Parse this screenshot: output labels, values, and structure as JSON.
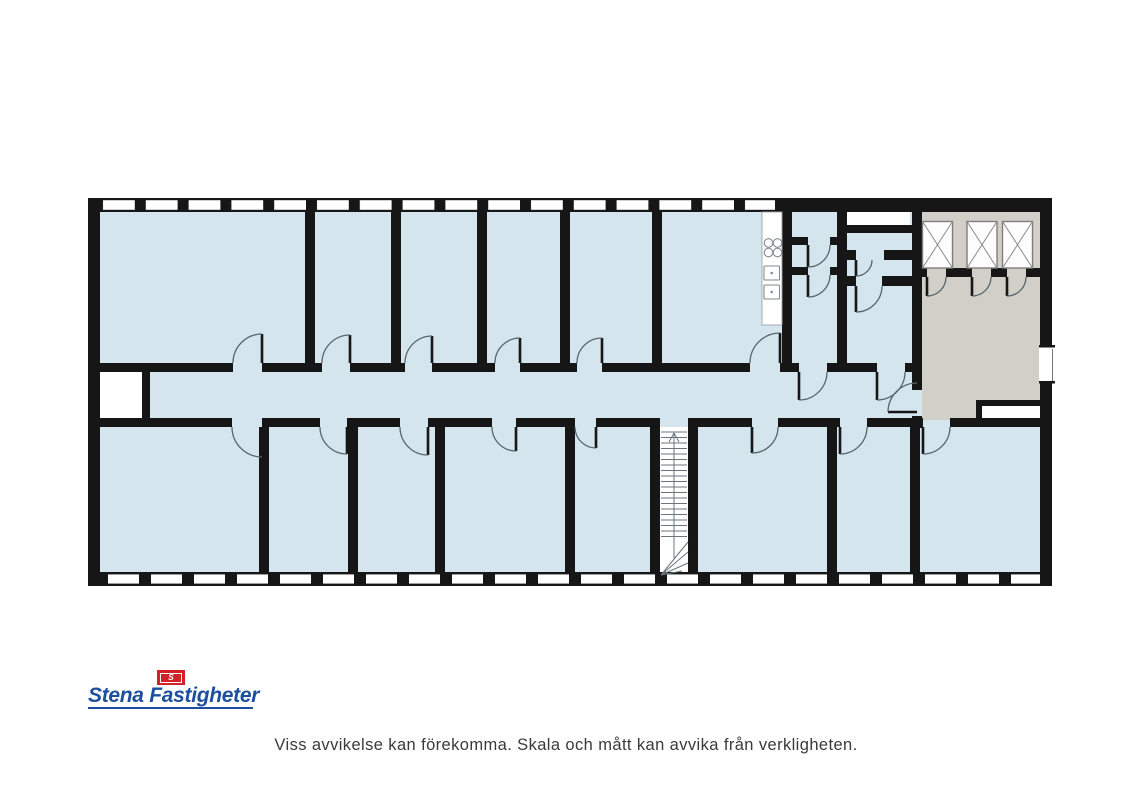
{
  "logo": {
    "brand": "Stena Fastigheter",
    "flag_letter": "S"
  },
  "disclaimer": "Viss avvikelse kan förekomma. Skala och mått kan avvika från verkligheten.",
  "plan": {
    "elevator_count": 3,
    "staircase_count": 1,
    "icons": {
      "elevator-symbol": "crossed-box",
      "stair-direction": "up-arrow",
      "stove-symbol": "four-burners",
      "sink-symbol": "twin-basins"
    }
  },
  "palette": {
    "room_fill": "#d5e5ee",
    "lobby_fill": "#d2cfc9",
    "wall": "#161616",
    "door_stroke": "#57666d",
    "logo_blue": "#1d4f9f",
    "logo_red": "#d42027",
    "disclaimer_color": "#3a3a3a",
    "background": "#ffffff"
  }
}
